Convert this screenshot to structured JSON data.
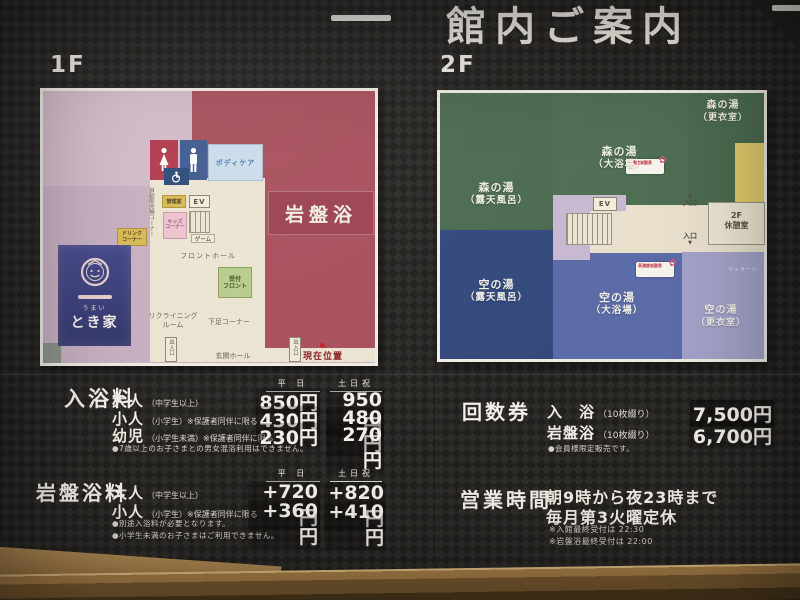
{
  "title": "館内ご案内",
  "colors": {
    "board_bg": "#24221f",
    "map_border": "#efece4",
    "mauve": "#c7b0c1",
    "ganban_red": "#a8505c",
    "ganban_box_red": "#9c4352",
    "floor_cream": "#ece4d2",
    "restroom_female_red": "#b23a4e",
    "restroom_male_blue": "#3f5c90",
    "mori_green": "#4c6b50",
    "sora_dark_blue": "#33497c",
    "sora_mid_blue": "#5c6ca8",
    "sora_light_purple": "#a2a3c8",
    "corridor_purple": "#c8b8d2",
    "accent_yellow": "#dfca6b",
    "wood": "#8a6436",
    "current_location_red": "#c42030"
  },
  "floors": {
    "f1": {
      "label": "1F",
      "areas": {
        "ganbanyoku": "岩盤浴",
        "kanri": "管理室",
        "ev": "EV",
        "kids": {
          "line1": "キッズ",
          "line2": "コーナー"
        },
        "game": "ゲーム",
        "front_hall": "フロントホール",
        "reception": {
          "line1": "受付",
          "line2": "フロント"
        },
        "reclining": {
          "line1": "リクライニング",
          "line2": "ルーム"
        },
        "shoe": "下足コーナー",
        "entrance_hall": "玄関ホール",
        "exit": "出入口",
        "current": "現在位置",
        "drink": {
          "line1": "ドリンク",
          "line2": "コーナー"
        },
        "vending": "自動販売機コーナー",
        "bodycare": "ボディケア",
        "tokiya": {
          "top": "うまい",
          "name": "とき家"
        }
      }
    },
    "f2": {
      "label": "2F",
      "areas": {
        "mori_roten": {
          "name": "森の湯",
          "sub": "（露天風呂）"
        },
        "mori_daiyoku": {
          "name": "森の湯",
          "sub": "（大浴場）"
        },
        "mori_koui": {
          "name": "森の湯",
          "sub": "（更衣室）"
        },
        "sora_roten": {
          "name": "空の湯",
          "sub": "（露天風呂）"
        },
        "sora_daiyoku": {
          "name": "空の湯",
          "sub": "（大浴場）"
        },
        "sora_koui": {
          "name": "空の湯",
          "sub": "（更衣室）"
        },
        "rest": {
          "line1": "2F",
          "line2": "休憩室"
        },
        "ev": "EV",
        "entrance": "入口",
        "massage": "マッサージ",
        "badge": "高濃度炭酸泉"
      }
    }
  },
  "fees": {
    "bath": {
      "heading": "入浴料",
      "col_weekday": "平 日",
      "col_weekend": "土日祝",
      "rows": [
        {
          "name": "大人",
          "note": "（中学生以上）",
          "weekday": "850円",
          "weekend": "950円"
        },
        {
          "name": "小人",
          "note": "（小学生）※保護者同伴に限る",
          "weekday": "430円",
          "weekend": "480円"
        },
        {
          "name": "幼児",
          "note": "（小学生未満）※保護者同伴に限る",
          "weekday": "230円",
          "weekend": "270円"
        }
      ],
      "footnote": "●7歳以上のお子さまとの男女混浴利用はできません。"
    },
    "ganban": {
      "heading": "岩盤浴料",
      "col_weekday": "平 日",
      "col_weekend": "土日祝",
      "rows": [
        {
          "name": "大人",
          "note": "（中学生以上）",
          "weekday": "+720円",
          "weekend": "+820円"
        },
        {
          "name": "小人",
          "note": "（小学生）※保護者同伴に限る",
          "weekday": "+360円",
          "weekend": "+410円"
        }
      ],
      "footnotes": [
        "●別途入浴料が必要となります。",
        "●小学生未満のお子さまはご利用できません。"
      ]
    },
    "tickets": {
      "heading": "回数券",
      "rows": [
        {
          "name": "入　浴",
          "note": "（10枚綴り）",
          "price": "7,500円"
        },
        {
          "name": "岩盤浴",
          "note": "（10枚綴り）",
          "price": "6,700円"
        }
      ],
      "footnote": "●会員様限定販売です。"
    },
    "hours": {
      "heading": "営業時間",
      "line1": "朝9時から夜23時まで",
      "line2": "毎月第3火曜定休",
      "notes": [
        "※入館最終受付は 22:30",
        "※岩盤浴最終受付は 22:00"
      ]
    }
  }
}
